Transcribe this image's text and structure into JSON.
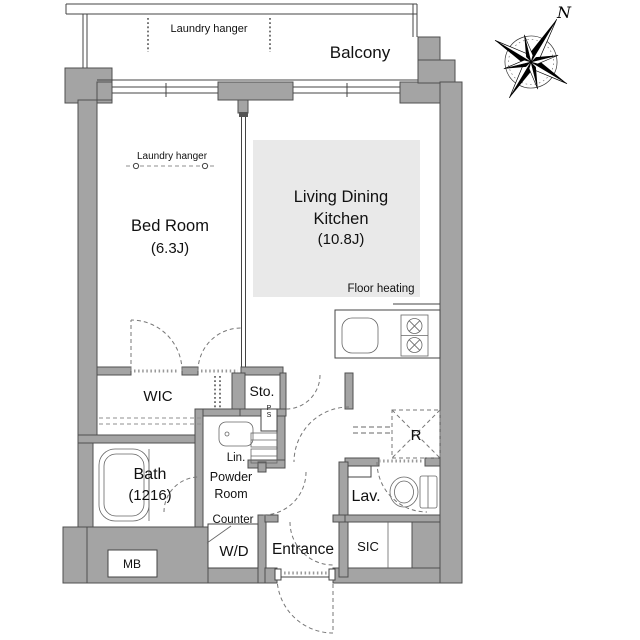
{
  "plan": {
    "balcony": {
      "label": "Balcony",
      "laundry_hanger": "Laundry hanger"
    },
    "bedroom": {
      "name": "Bed Room",
      "size": "(6.3J)",
      "laundry_hanger": "Laundry hanger"
    },
    "ldk": {
      "name_line1": "Living Dining",
      "name_line2": "Kitchen",
      "size": "(10.8J)",
      "floor_heating": "Floor heating"
    },
    "wic": {
      "name": "WIC"
    },
    "storage": {
      "name": "Sto."
    },
    "bath": {
      "name": "Bath",
      "size": "(1216)"
    },
    "linen": {
      "name": "Lin."
    },
    "pipe_space": {
      "name": "PS"
    },
    "powder_room": {
      "line1": "Powder",
      "line2": "Room"
    },
    "counter": {
      "name": "Counter"
    },
    "washer_dryer": {
      "name": "W/D"
    },
    "entrance": {
      "name": "Entrance"
    },
    "shoe_closet": {
      "name": "SIC"
    },
    "lavatory": {
      "name": "Lav."
    },
    "refrigerator": {
      "name": "R"
    },
    "meter_box": {
      "name": "MB"
    },
    "compass": {
      "north": "N"
    }
  },
  "colors": {
    "wall": "#a4a4a4",
    "wall_outline": "#4f4f4f",
    "floor_heating_fill": "#e9e9e9",
    "line": "#444444",
    "dashed": "#8f8f8f",
    "text": "#111111"
  }
}
